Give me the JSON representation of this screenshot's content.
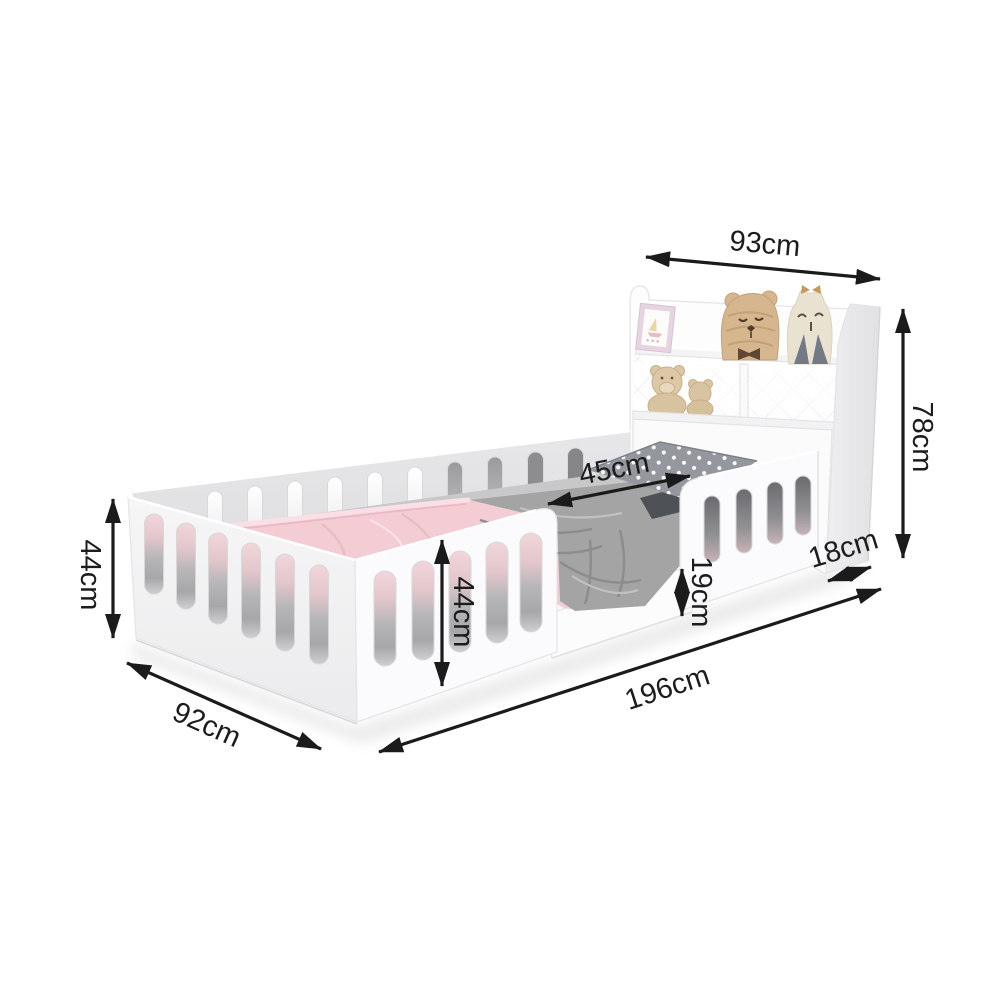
{
  "description": "Dimension diagram of a white toddler floor bed with safety rails, entry opening and headboard bookshelf with plush toys",
  "unit": "cm",
  "dimensions": {
    "headboard_width": "93cm",
    "headboard_height": "78cm",
    "foot_rail_height": "44cm",
    "bed_width": "92cm",
    "entry_opening_width": "45cm",
    "front_rail_height": "44cm",
    "platform_height": "19cm",
    "headboard_depth": "18cm",
    "bed_length": "196cm"
  },
  "colors": {
    "background": "#ffffff",
    "annotation": "#1c1c1c",
    "panel_white": "#fbfbfd",
    "panel_shadow": "#e8e8ea",
    "blanket_pink": "#f3ccd4",
    "duvet_gray": "#a4a4a5",
    "pillow_polka_gray": "#94979e",
    "toy_tan": "#d6b68f",
    "toy_cream": "#eae2d1"
  }
}
